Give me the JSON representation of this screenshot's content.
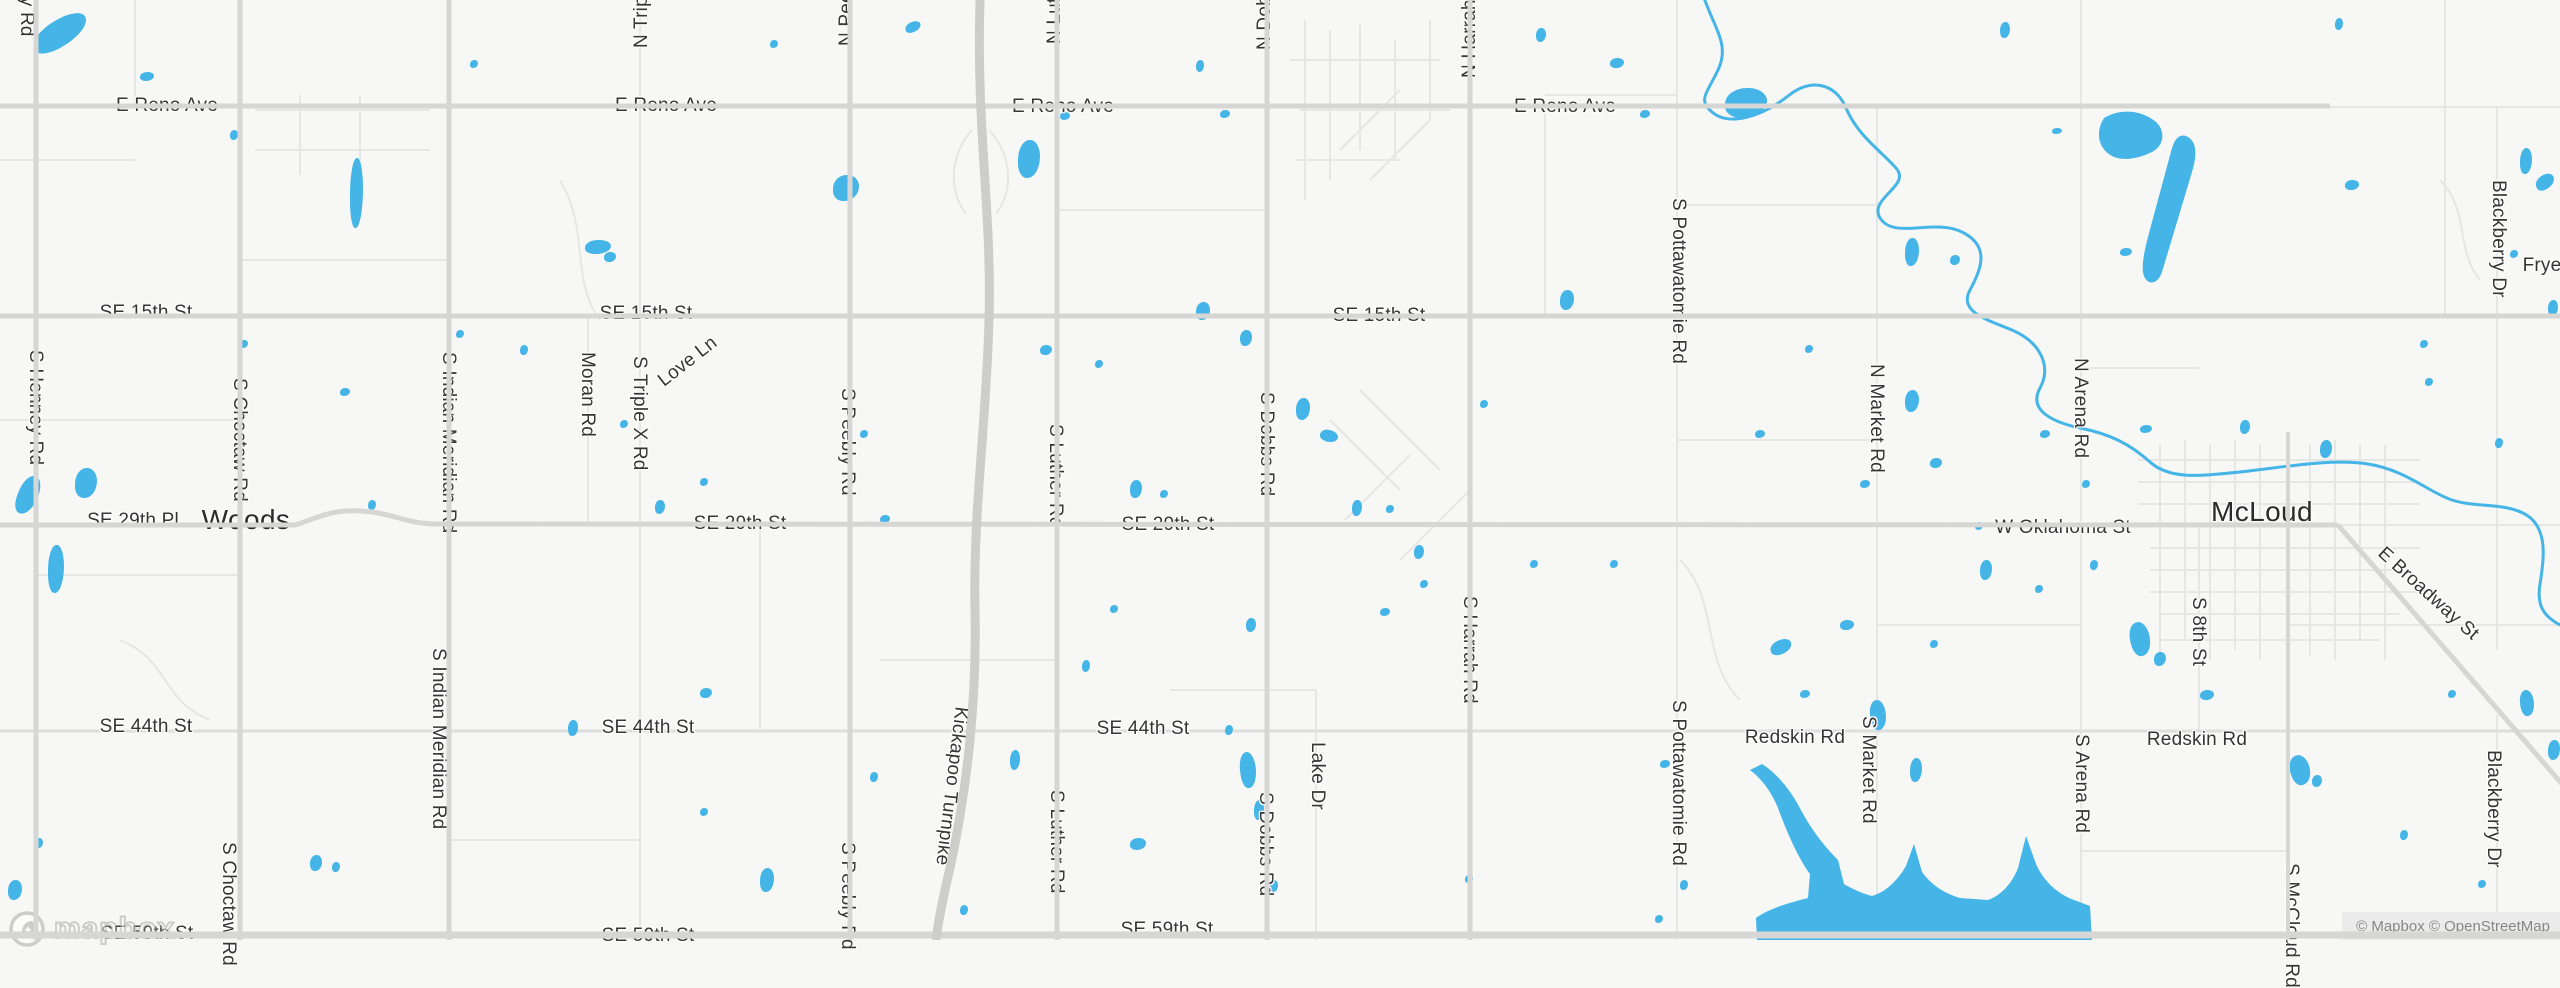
{
  "map": {
    "colors": {
      "land": "#f7f7f5",
      "water": "#45b5e8",
      "road_major": "#d6d6d4",
      "road_secondary": "#dedede",
      "road_minor": "#e6e6e4",
      "road_turnpike": "#cdcdcb",
      "label": "#353535",
      "town": "#2b2b2b",
      "attribution_bg": "#ebebeb",
      "attribution_text": "#7d7d7d"
    },
    "attribution": {
      "text": "© Mapbox © OpenStreetMap"
    },
    "logo": {
      "text": "mapbox"
    },
    "towns": [
      {
        "name": "Woods",
        "x": 246,
        "y": 520
      },
      {
        "name": "McLoud",
        "x": 2262,
        "y": 512
      }
    ],
    "street_labels_horizontal": [
      {
        "text": "E Reno Ave",
        "x": 167,
        "y": 106
      },
      {
        "text": "E Reno Ave",
        "x": 666,
        "y": 106
      },
      {
        "text": "E Reno Ave",
        "x": 1063,
        "y": 107
      },
      {
        "text": "E Reno Ave",
        "x": 1565,
        "y": 107
      },
      {
        "text": "SE 15th St",
        "x": 146,
        "y": 313
      },
      {
        "text": "SE 15th St",
        "x": 646,
        "y": 314
      },
      {
        "text": "SE 15th St",
        "x": 1379,
        "y": 316
      },
      {
        "text": "SE 29th Pl",
        "x": 133,
        "y": 521
      },
      {
        "text": "SE 29th St",
        "x": 740,
        "y": 524
      },
      {
        "text": "SE 29th St",
        "x": 1168,
        "y": 525
      },
      {
        "text": "W Oklahoma St",
        "x": 2063,
        "y": 528
      },
      {
        "text": "SE 44th St",
        "x": 146,
        "y": 727
      },
      {
        "text": "SE 44th St",
        "x": 648,
        "y": 728
      },
      {
        "text": "SE 44th St",
        "x": 1143,
        "y": 729
      },
      {
        "text": "Redskin Rd",
        "x": 1795,
        "y": 738
      },
      {
        "text": "Redskin Rd",
        "x": 2197,
        "y": 740
      },
      {
        "text": "SE 59th St",
        "x": 147,
        "y": 934
      },
      {
        "text": "SE 59th St",
        "x": 648,
        "y": 936
      },
      {
        "text": "SE 59th St",
        "x": 1167,
        "y": 930
      },
      {
        "text": "Frye",
        "x": 2542,
        "y": 266
      }
    ],
    "street_labels_vertical_down": [
      {
        "text": "ey Rd",
        "x": 27,
        "y": -14
      },
      {
        "text": "S Henney Rd",
        "x": 36,
        "y": 350
      },
      {
        "text": "S Choctaw Rd",
        "x": 240,
        "y": 378
      },
      {
        "text": "S Indian Meridian Rd",
        "x": 449,
        "y": 352
      },
      {
        "text": "Moran Rd",
        "x": 588,
        "y": 352
      },
      {
        "text": "S Triple X Rd",
        "x": 640,
        "y": 356
      },
      {
        "text": "S Peebly Rd",
        "x": 848,
        "y": 388
      },
      {
        "text": "S Luther Rd",
        "x": 1056,
        "y": 424
      },
      {
        "text": "S Dobbs Rd",
        "x": 1267,
        "y": 392
      },
      {
        "text": "S Pottawatomie Rd",
        "x": 1679,
        "y": 198
      },
      {
        "text": "S Harrah Rd",
        "x": 1470,
        "y": 596
      },
      {
        "text": "Lake Dr",
        "x": 1318,
        "y": 742
      },
      {
        "text": "S Pottawatomie Rd",
        "x": 1679,
        "y": 700
      },
      {
        "text": "N Market Rd",
        "x": 1877,
        "y": 364
      },
      {
        "text": "N Arena Rd",
        "x": 2081,
        "y": 358
      },
      {
        "text": "S Market Rd",
        "x": 1869,
        "y": 716
      },
      {
        "text": "S Arena Rd",
        "x": 2082,
        "y": 734
      },
      {
        "text": "S 8th St",
        "x": 2199,
        "y": 597
      },
      {
        "text": "S McCloud Rd",
        "x": 2292,
        "y": 863
      },
      {
        "text": "Blackberry Dr",
        "x": 2499,
        "y": 180
      },
      {
        "text": "Blackberry Dr",
        "x": 2494,
        "y": 750
      },
      {
        "text": "S Choctaw Rd",
        "x": 229,
        "y": 842
      },
      {
        "text": "S Indian Meridian Rd",
        "x": 439,
        "y": 648
      },
      {
        "text": "S Peebly Rd",
        "x": 848,
        "y": 842
      },
      {
        "text": "S Luther Rd",
        "x": 1057,
        "y": 790
      },
      {
        "text": "S Dobbs Rd",
        "x": 1266,
        "y": 792
      }
    ],
    "street_labels_vertical_up": [
      {
        "text": "N Triple X Rd",
        "x": 641,
        "y": 48
      },
      {
        "text": "N Peebly Rd",
        "x": 846,
        "y": 46
      },
      {
        "text": "N Luther Rd",
        "x": 1054,
        "y": 44
      },
      {
        "text": "N Dobbs Rd",
        "x": 1264,
        "y": 50
      },
      {
        "text": "N Harrah Rd",
        "x": 1469,
        "y": 78
      }
    ],
    "street_labels_diagonal": [
      {
        "text": "Love Ln",
        "x": 688,
        "y": 362,
        "deg": -38
      },
      {
        "text": "Kickapoo Turnpike",
        "x": 951,
        "y": 786,
        "deg": 97
      },
      {
        "text": "E Broadway St",
        "x": 2428,
        "y": 594,
        "deg": 42
      }
    ],
    "ponds": [
      [
        30,
        20,
        60,
        26,
        -30
      ],
      [
        140,
        72,
        14,
        9,
        0
      ],
      [
        350,
        158,
        13,
        70,
        0
      ],
      [
        585,
        240,
        26,
        14,
        0
      ],
      [
        604,
        252,
        12,
        10,
        0
      ],
      [
        833,
        175,
        26,
        26,
        0
      ],
      [
        905,
        22,
        16,
        10,
        -20
      ],
      [
        1018,
        140,
        22,
        38,
        0
      ],
      [
        1060,
        112,
        10,
        8,
        0
      ],
      [
        1196,
        60,
        8,
        12,
        0
      ],
      [
        1220,
        110,
        10,
        8,
        0
      ],
      [
        1536,
        28,
        10,
        14,
        0
      ],
      [
        1725,
        88,
        42,
        30,
        0
      ],
      [
        1905,
        238,
        14,
        28,
        0
      ],
      [
        1950,
        255,
        10,
        10,
        0
      ],
      [
        2000,
        22,
        10,
        16,
        0
      ],
      [
        2335,
        18,
        8,
        12,
        0
      ],
      [
        2345,
        180,
        14,
        10,
        0
      ],
      [
        2520,
        148,
        12,
        26,
        0
      ],
      [
        2535,
        175,
        20,
        14,
        -30
      ],
      [
        2510,
        250,
        8,
        8,
        0
      ],
      [
        2548,
        300,
        10,
        16,
        0
      ],
      [
        1640,
        110,
        10,
        8,
        0
      ],
      [
        770,
        40,
        8,
        8,
        0
      ],
      [
        470,
        60,
        8,
        8,
        0
      ],
      [
        230,
        130,
        8,
        10,
        0
      ],
      [
        18,
        475,
        20,
        40,
        20
      ],
      [
        75,
        468,
        22,
        30,
        0
      ],
      [
        48,
        545,
        16,
        48,
        0
      ],
      [
        240,
        340,
        8,
        8,
        0
      ],
      [
        340,
        388,
        10,
        8,
        0
      ],
      [
        368,
        500,
        8,
        10,
        0
      ],
      [
        456,
        330,
        8,
        8,
        0
      ],
      [
        520,
        345,
        8,
        10,
        0
      ],
      [
        620,
        420,
        8,
        8,
        0
      ],
      [
        655,
        500,
        10,
        14,
        0
      ],
      [
        700,
        478,
        8,
        8,
        0
      ],
      [
        860,
        430,
        8,
        8,
        0
      ],
      [
        880,
        515,
        10,
        8,
        0
      ],
      [
        1040,
        345,
        12,
        10,
        0
      ],
      [
        1095,
        360,
        8,
        8,
        0
      ],
      [
        1130,
        480,
        12,
        18,
        0
      ],
      [
        1160,
        490,
        8,
        8,
        0
      ],
      [
        1296,
        398,
        14,
        22,
        0
      ],
      [
        1320,
        430,
        18,
        12,
        20
      ],
      [
        1352,
        500,
        10,
        16,
        0
      ],
      [
        1386,
        505,
        8,
        8,
        0
      ],
      [
        1414,
        545,
        10,
        14,
        0
      ],
      [
        1480,
        400,
        8,
        8,
        0
      ],
      [
        1560,
        290,
        14,
        20,
        0
      ],
      [
        1196,
        302,
        14,
        18,
        0
      ],
      [
        1240,
        330,
        12,
        16,
        0
      ],
      [
        1610,
        58,
        14,
        10,
        0
      ],
      [
        1755,
        430,
        10,
        8,
        0
      ],
      [
        1805,
        345,
        8,
        8,
        0
      ],
      [
        1860,
        480,
        10,
        8,
        0
      ],
      [
        1905,
        390,
        14,
        22,
        0
      ],
      [
        1930,
        458,
        12,
        10,
        0
      ],
      [
        1975,
        522,
        8,
        8,
        0
      ],
      [
        2040,
        430,
        10,
        8,
        0
      ],
      [
        2082,
        480,
        8,
        8,
        0
      ],
      [
        2140,
        425,
        12,
        8,
        0
      ],
      [
        2240,
        420,
        10,
        14,
        0
      ],
      [
        2320,
        440,
        12,
        18,
        0
      ],
      [
        2425,
        378,
        8,
        8,
        0
      ],
      [
        2495,
        438,
        8,
        10,
        0
      ],
      [
        2420,
        340,
        8,
        8,
        0
      ],
      [
        8,
        880,
        14,
        20,
        0
      ],
      [
        35,
        838,
        8,
        10,
        0
      ],
      [
        310,
        855,
        12,
        16,
        0
      ],
      [
        332,
        862,
        8,
        10,
        0
      ],
      [
        568,
        720,
        10,
        16,
        0
      ],
      [
        700,
        688,
        12,
        10,
        0
      ],
      [
        760,
        868,
        14,
        24,
        0
      ],
      [
        700,
        808,
        8,
        8,
        0
      ],
      [
        870,
        772,
        8,
        10,
        0
      ],
      [
        1010,
        750,
        10,
        20,
        0
      ],
      [
        1082,
        660,
        8,
        12,
        0
      ],
      [
        1110,
        605,
        8,
        8,
        0
      ],
      [
        1246,
        618,
        10,
        14,
        0
      ],
      [
        1270,
        880,
        8,
        12,
        0
      ],
      [
        1380,
        608,
        10,
        8,
        0
      ],
      [
        1420,
        580,
        8,
        8,
        0
      ],
      [
        1465,
        875,
        8,
        8,
        0
      ],
      [
        1530,
        560,
        8,
        8,
        0
      ],
      [
        1610,
        560,
        8,
        8,
        0
      ],
      [
        1660,
        760,
        10,
        8,
        0
      ],
      [
        1680,
        880,
        8,
        10,
        0
      ],
      [
        1770,
        640,
        22,
        14,
        -20
      ],
      [
        1800,
        690,
        10,
        8,
        0
      ],
      [
        1840,
        620,
        14,
        10,
        0
      ],
      [
        1870,
        700,
        16,
        30,
        -10
      ],
      [
        1910,
        758,
        12,
        24,
        0
      ],
      [
        1930,
        640,
        8,
        8,
        0
      ],
      [
        1980,
        560,
        12,
        20,
        0
      ],
      [
        2035,
        585,
        8,
        8,
        0
      ],
      [
        2090,
        560,
        8,
        10,
        0
      ],
      [
        2130,
        622,
        20,
        34,
        -15
      ],
      [
        2154,
        652,
        12,
        14,
        0
      ],
      [
        2200,
        690,
        14,
        10,
        0
      ],
      [
        2290,
        755,
        20,
        30,
        -20
      ],
      [
        2312,
        775,
        10,
        12,
        0
      ],
      [
        2400,
        830,
        8,
        10,
        0
      ],
      [
        2448,
        690,
        8,
        8,
        0
      ],
      [
        2520,
        690,
        14,
        26,
        -10
      ],
      [
        2548,
        740,
        12,
        20,
        0
      ],
      [
        1240,
        752,
        16,
        36,
        -8
      ],
      [
        1254,
        800,
        10,
        20,
        0
      ],
      [
        1225,
        725,
        8,
        10,
        0
      ],
      [
        1655,
        915,
        8,
        8,
        0
      ],
      [
        2478,
        880,
        8,
        8,
        0
      ],
      [
        1130,
        838,
        16,
        12,
        0
      ],
      [
        960,
        905,
        8,
        10,
        0
      ],
      [
        2052,
        128,
        10,
        6,
        0
      ],
      [
        2120,
        248,
        12,
        8,
        0
      ]
    ]
  }
}
